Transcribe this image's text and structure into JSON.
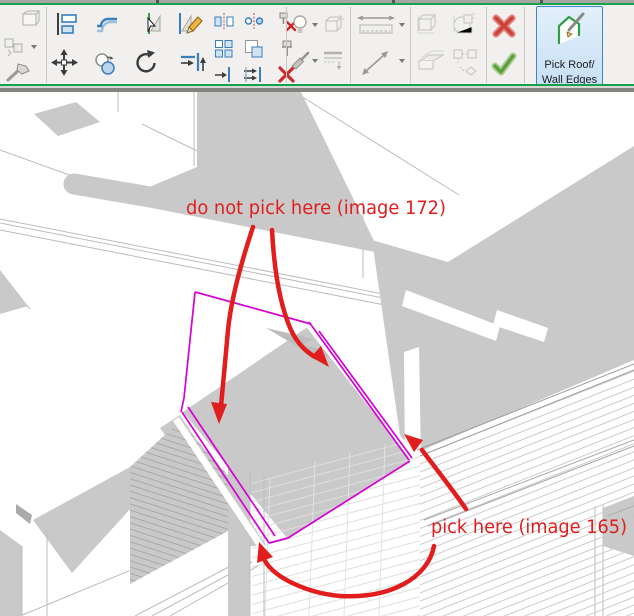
{
  "app": {
    "title": "Revit modify toolbar with roof sketch view"
  },
  "toolbar": {
    "groups": [
      {
        "name": "edit-clipped",
        "icons": [
          "box-icon",
          "group-icon",
          "demolish-hammer-icon"
        ]
      },
      {
        "name": "modify-basic",
        "icons": [
          "align-icon",
          "offset-icon",
          "pick-lines-icon",
          "pick-edit-icon",
          "move-icon",
          "copy-icon",
          "rotate-icon",
          "corner-join-icon"
        ]
      },
      {
        "name": "modify-extra",
        "icons": [
          "mirror-icon",
          "mirror-project-icon",
          "unpin-icon",
          "array-icon",
          "scale-icon",
          "pin-icon",
          "trim-icon",
          "trim-multi-icon",
          "delete-icon"
        ]
      },
      {
        "name": "view-graphics",
        "icons": [
          "lightbulb-icon",
          "shadow-box-icon",
          "paintbrush-icon",
          "linework-icon"
        ]
      },
      {
        "name": "measure",
        "icons": [
          "measure-horizontal-icon",
          "measure-diagonal-icon"
        ]
      },
      {
        "name": "create-group",
        "icons": [
          "group-boxes-icon",
          "model-group-icon",
          "wall-slab-icon",
          "convert-group-icon"
        ]
      },
      {
        "name": "confirm",
        "icons": [
          "cancel-x-icon",
          "finish-check-icon"
        ]
      }
    ],
    "pick_button": {
      "label_line1": "Pick Roof/",
      "label_line2": "Wall Edges"
    }
  },
  "canvas": {
    "annotations": {
      "warning_text": "do not pick here (image 172)",
      "instruction_text": "pick here (image 165)"
    },
    "sketch": {
      "element": "roof-footprint-sketch",
      "edge_style": "magenta outline, doubled on eave edges"
    }
  },
  "colors": {
    "annotation_red": "#e11d1d",
    "sketch_magenta": "#d400d4",
    "toolbar_green_line": "#16a24c",
    "selected_button_blue": "#3c87c8",
    "selected_button_fill": "#cfe4f7",
    "surface_gray": "#c9c9c9",
    "toolbar_bg": "#f1f0ee"
  }
}
